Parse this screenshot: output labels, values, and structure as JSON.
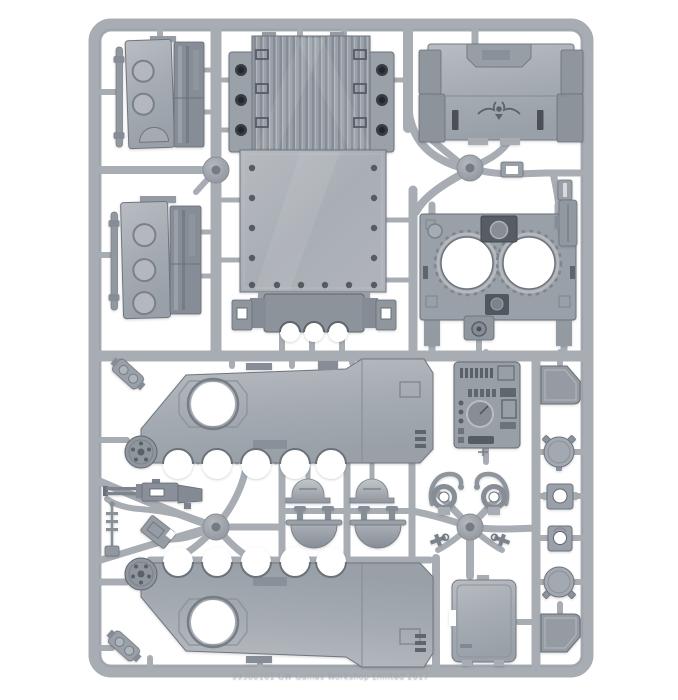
{
  "meta": {
    "description": "Product photo of a grey polystyrene model-kit sprue (tank vehicle frame) on a plain white background",
    "alt": "Plastic sprue holding armoured-vehicle model parts"
  },
  "palette": {
    "background": "#ffffff",
    "rail": "#a8adb4",
    "rail_edge": "#90969e",
    "rail_highlight": "#c9ccd1",
    "part_light": "#b9bdc3",
    "part_mid": "#a0a6ae",
    "part_dark": "#868d96",
    "panel_shadow": "#6f757e",
    "detail_dark": "#4b5058",
    "hole_dark": "#383d44",
    "cutout": "#ffffff",
    "emboss": "#8f959c",
    "emboss_light": "#d2d5d9"
  },
  "sprue": {
    "embossed_text": "99380101 GW   Games Workshop Limited 2017",
    "material": "grey polystyrene",
    "injection_points": 4,
    "parts": [
      {
        "id": "hatch-door-1",
        "label": "Side hatch door with hinge rod and port circles"
      },
      {
        "id": "hatch-door-2",
        "label": "Side hatch door with hinge rod and port circles"
      },
      {
        "id": "engine-deck",
        "label": "Ribbed engine deck with side flanges"
      },
      {
        "id": "hull-floor",
        "label": "Hull floor panel with rivet holes"
      },
      {
        "id": "suspension-unit",
        "label": "Suspension axle unit with arch cut-outs"
      },
      {
        "id": "rear-door",
        "label": "Rear ramp door with winged-eagle emblem"
      },
      {
        "id": "twin-hatch-roof",
        "label": "Roof section with two circular hatch openings"
      },
      {
        "id": "side-armor-upper",
        "label": "Hull side with track guard, door hole, wheel arches, drive hub"
      },
      {
        "id": "side-armor-lower",
        "label": "Mirrored hull side with track guard, door hole, wheel arches, drive hub"
      },
      {
        "id": "dashboard-console",
        "label": "Driver instrument console panel with gauge"
      },
      {
        "id": "ramp-door",
        "label": "Plain rectangular hatch door"
      },
      {
        "id": "corner-plate-top",
        "label": "Angled armour plate"
      },
      {
        "id": "corner-plate-bottom",
        "label": "Angled armour plate"
      },
      {
        "id": "round-hatch-1",
        "label": "Round hatch with clasp lugs"
      },
      {
        "id": "round-hatch-2",
        "label": "Round hatch with clasp lugs"
      },
      {
        "id": "socket-plate-1",
        "label": "Square mounting plate with through hole"
      },
      {
        "id": "socket-plate-2",
        "label": "Square mounting plate with through hole"
      },
      {
        "id": "dome-hatch-1",
        "label": "Domed cupola hatch"
      },
      {
        "id": "dome-hatch-2",
        "label": "Domed cupola hatch"
      },
      {
        "id": "bowl-hatch-1",
        "label": "Hatch bowl with hinge lugs"
      },
      {
        "id": "bowl-hatch-2",
        "label": "Hatch bowl with hinge lugs"
      },
      {
        "id": "headlight-1",
        "label": "Headlamp with curved brush guard"
      },
      {
        "id": "headlight-2",
        "label": "Headlamp with curved brush guard"
      },
      {
        "id": "tow-hook-1",
        "label": "Towing shackle"
      },
      {
        "id": "tow-hook-2",
        "label": "Towing shackle"
      },
      {
        "id": "storm-bolter",
        "label": "Twin-barrelled weapon"
      },
      {
        "id": "antenna",
        "label": "Radio antenna with finned base"
      },
      {
        "id": "periscope",
        "label": "Periscope block"
      },
      {
        "id": "bracket-1",
        "label": "Hinge bracket"
      },
      {
        "id": "bracket-2",
        "label": "Hinge bracket"
      },
      {
        "id": "rail-clip-small",
        "label": "Small latch fitting"
      },
      {
        "id": "rail-clip-tall",
        "label": "Mirror / latch fitting"
      },
      {
        "id": "buckle-clip",
        "label": "Latch buckle fitting"
      }
    ]
  }
}
